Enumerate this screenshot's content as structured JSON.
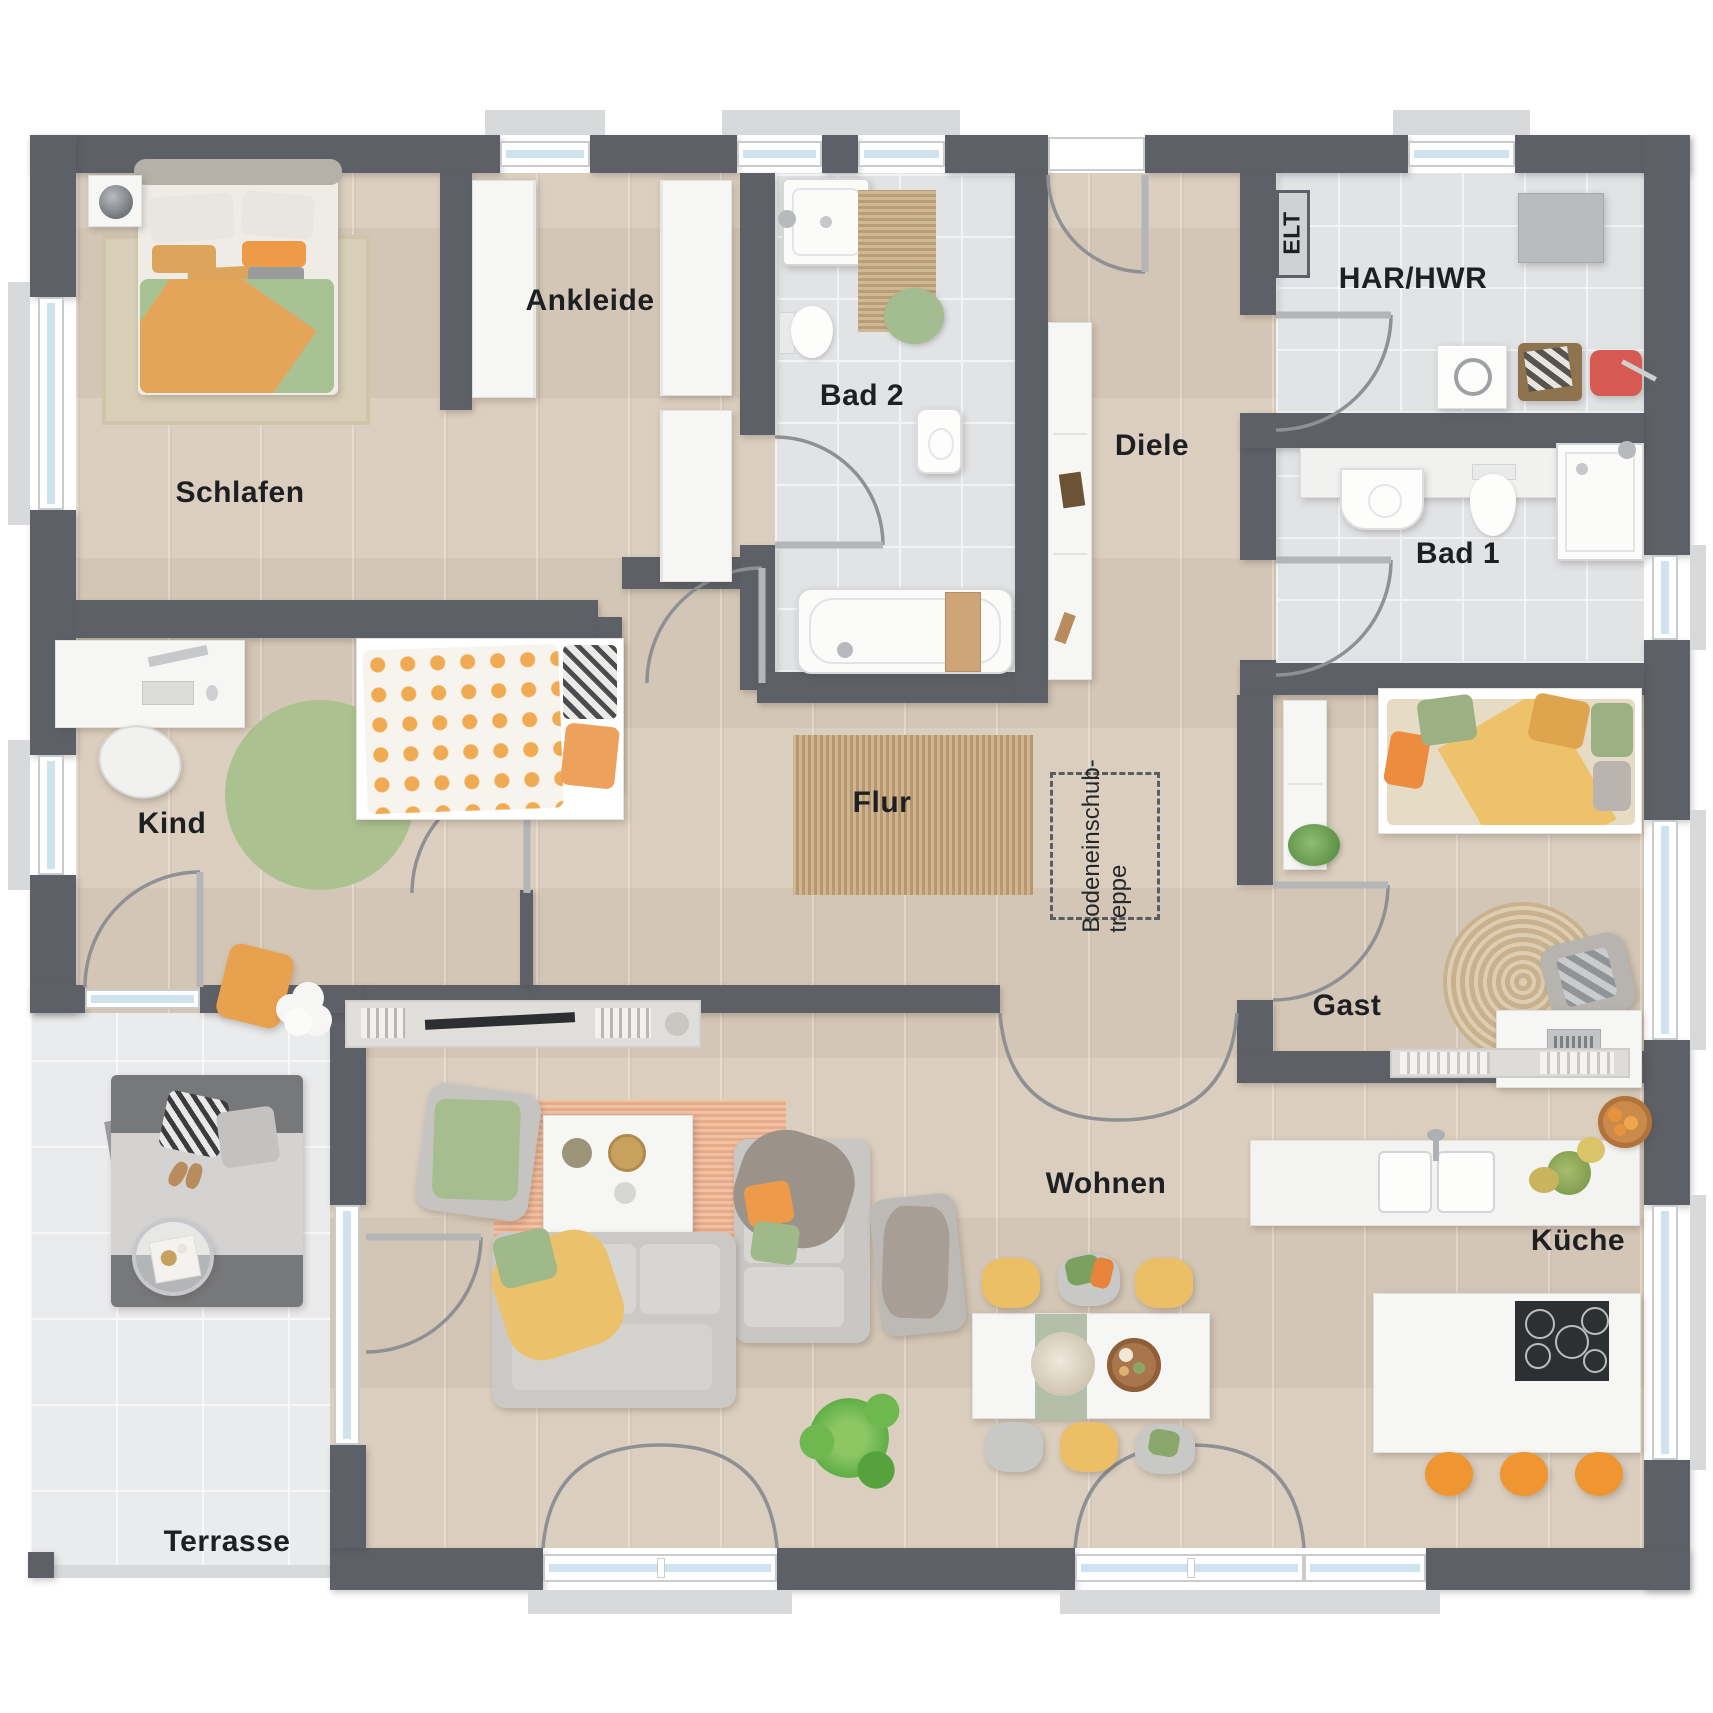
{
  "labels": {
    "schlafen": "Schlafen",
    "ankleide": "Ankleide",
    "bad2": "Bad 2",
    "diele": "Diele",
    "elt": "ELT",
    "har_hwr": "HAR/HWR",
    "bad1": "Bad 1",
    "kind": "Kind",
    "flur": "Flur",
    "gast": "Gast",
    "wohnen": "Wohnen",
    "kueche": "Küche",
    "terrasse": "Terrasse",
    "attic_stairs_line1": "Bodeneinschub-",
    "attic_stairs_line2": "treppe"
  },
  "colors": {
    "wall": "#5d6167",
    "wood_floor": "#d9ccbc",
    "tile_floor": "#e1e3e5",
    "terrace_floor": "#eaebec",
    "window_glass": "#cfe3ef",
    "accent_orange": "#ef9d4d",
    "accent_green": "#a9c294",
    "accent_yellow": "#ecc16b",
    "rug_jute": "#c2a074",
    "rug_terracotta": "#efb28f",
    "label_text": "#1d1f22"
  }
}
